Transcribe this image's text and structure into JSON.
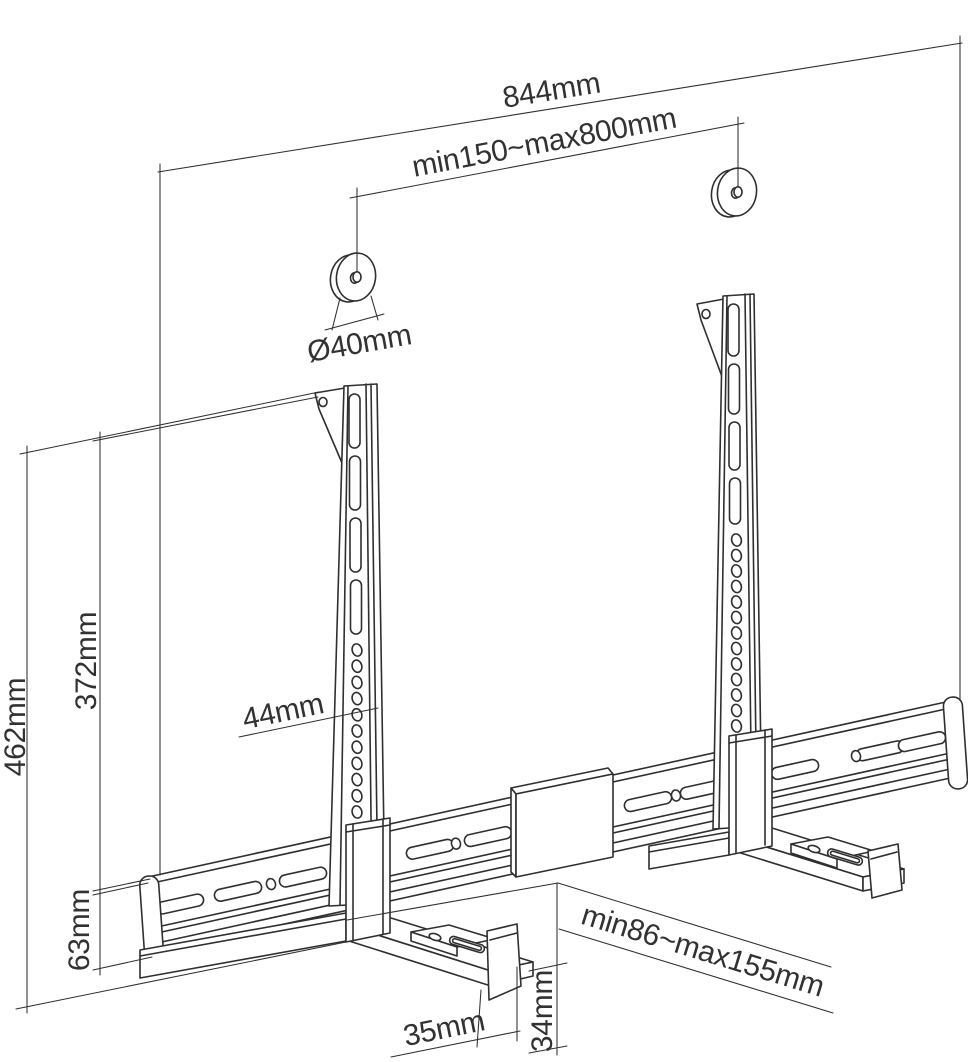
{
  "page": {
    "background": "#ffffff"
  },
  "drawing": {
    "kind": "soundbar-wall-mount-dimension-diagram",
    "line_color": "#2f2f2f",
    "text_color": "#323232",
    "labels": {
      "total_width": "844mm",
      "mount_hole_spacing": "min150~max800mm",
      "washer_diameter": "Ø40mm",
      "overall_height": "462mm",
      "strap_height": "372mm",
      "rail_height": "63mm",
      "strap_width": "44mm",
      "depth_adjustment": "min86~max155mm",
      "clamp_depth": "35mm",
      "clamp_lip_height": "34mm"
    }
  }
}
